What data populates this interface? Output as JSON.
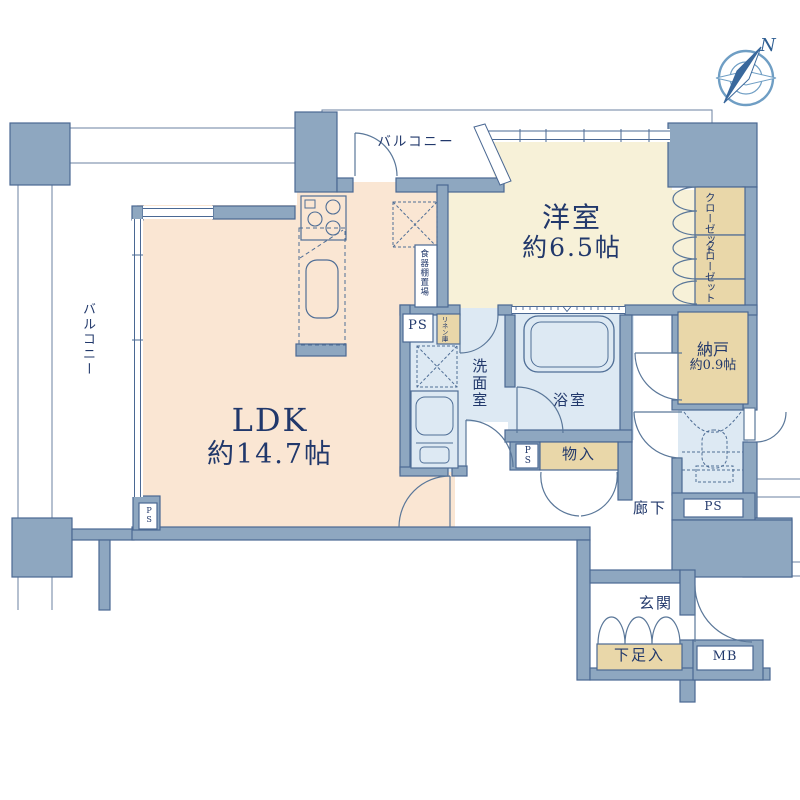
{
  "plan": {
    "type": "floor-plan",
    "compass": {
      "north_label": "N"
    },
    "rooms": {
      "ldk": {
        "name": "LDK",
        "area": "約14.7帖"
      },
      "western_room": {
        "name": "洋室",
        "area": "約6.5帖"
      },
      "storage_room": {
        "name": "納戸",
        "area": "約0.9帖"
      },
      "washroom": {
        "name": "洗面室"
      },
      "bathroom": {
        "name": "浴室"
      },
      "hallway": {
        "name": "廊下"
      },
      "entrance": {
        "name": "玄関"
      },
      "balcony_left": {
        "name": "バルコニー"
      },
      "balcony_top": {
        "name": "バルコニー"
      }
    },
    "storage": {
      "closet_upper": {
        "name": "クローゼット"
      },
      "closet_lower": {
        "name": "クローゼット"
      },
      "mono_ire": {
        "name": "物入"
      },
      "shoe_box": {
        "name": "下足入"
      },
      "linen": {
        "name": "リネン庫"
      },
      "dish_shelf": {
        "name": "食器棚置場"
      }
    },
    "utilities": {
      "ps_kitchen": "PS",
      "ps_toilet": "PS",
      "ps_ldk": "PS",
      "ps_hall": "PS",
      "meter_box": "MB"
    },
    "colors": {
      "wall": "#8ea7c0",
      "wall_edge": "#4a6893",
      "ldk_floor": "#fae6d3",
      "western_floor": "#f7f1d8",
      "wet_floor": "#dde9f3",
      "storage_fill": "#e9d7a9",
      "text": "#21386b",
      "compass": "#6f9ec4"
    }
  }
}
